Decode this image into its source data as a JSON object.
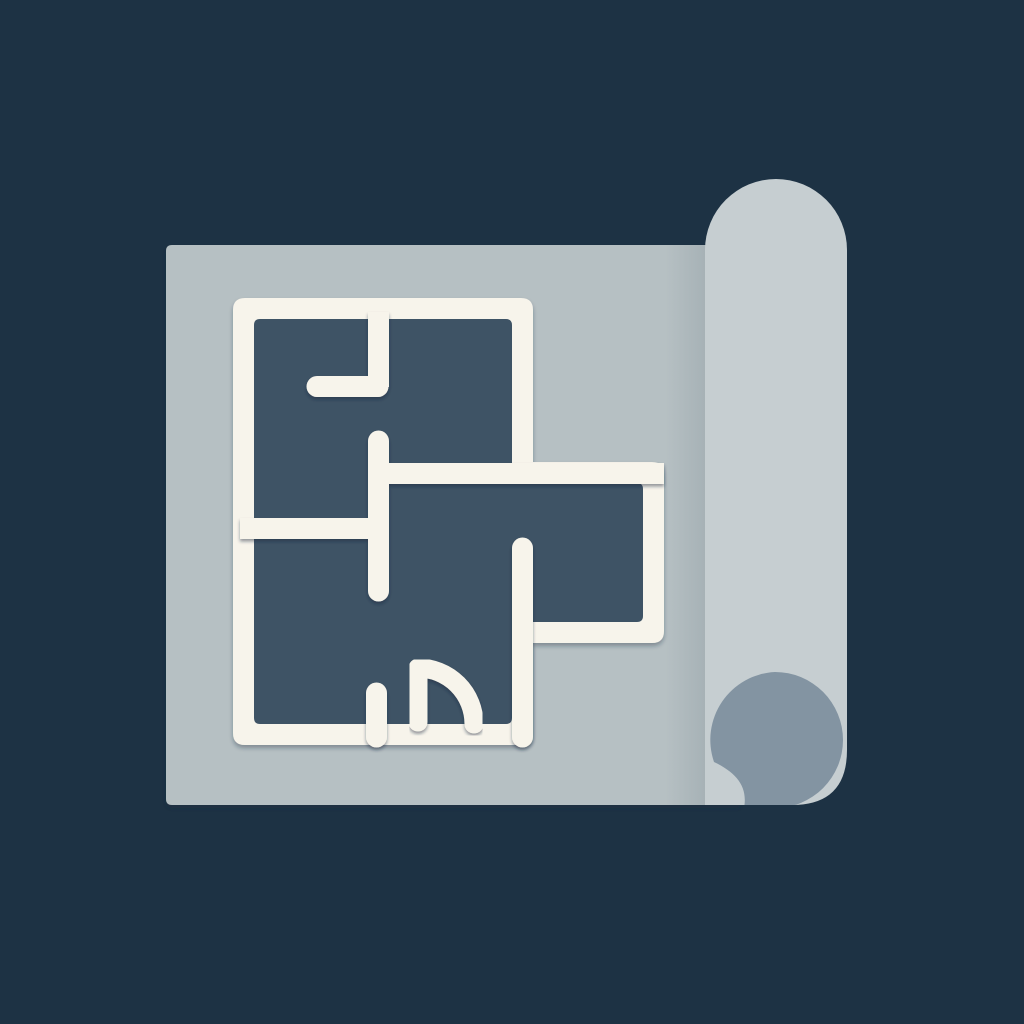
{
  "scene": {
    "type": "flat-illustration",
    "subject": "Rolled blueprint sheet with a cream floor plan drawn on dark slate rooms",
    "elements": [
      "background",
      "paper-sheet",
      "paper-roll",
      "roll-curl-shadow",
      "floor-plan"
    ]
  },
  "colors": {
    "background": "#1d3244",
    "paper_sheet": "#b6c0c3",
    "paper_roll": "#c6ced1",
    "roll_curl": "#8394a2",
    "plan_wall": "#f7f4eb",
    "plan_room": "#3e5365",
    "shadow": "#16283a"
  },
  "floor_plan": {
    "room_count": 4,
    "has_annex_room": true,
    "features": [
      "outer-walls",
      "interior-partition-walls",
      "rounded-wall-ends",
      "doorway-openings",
      "door-swing-arc"
    ]
  }
}
